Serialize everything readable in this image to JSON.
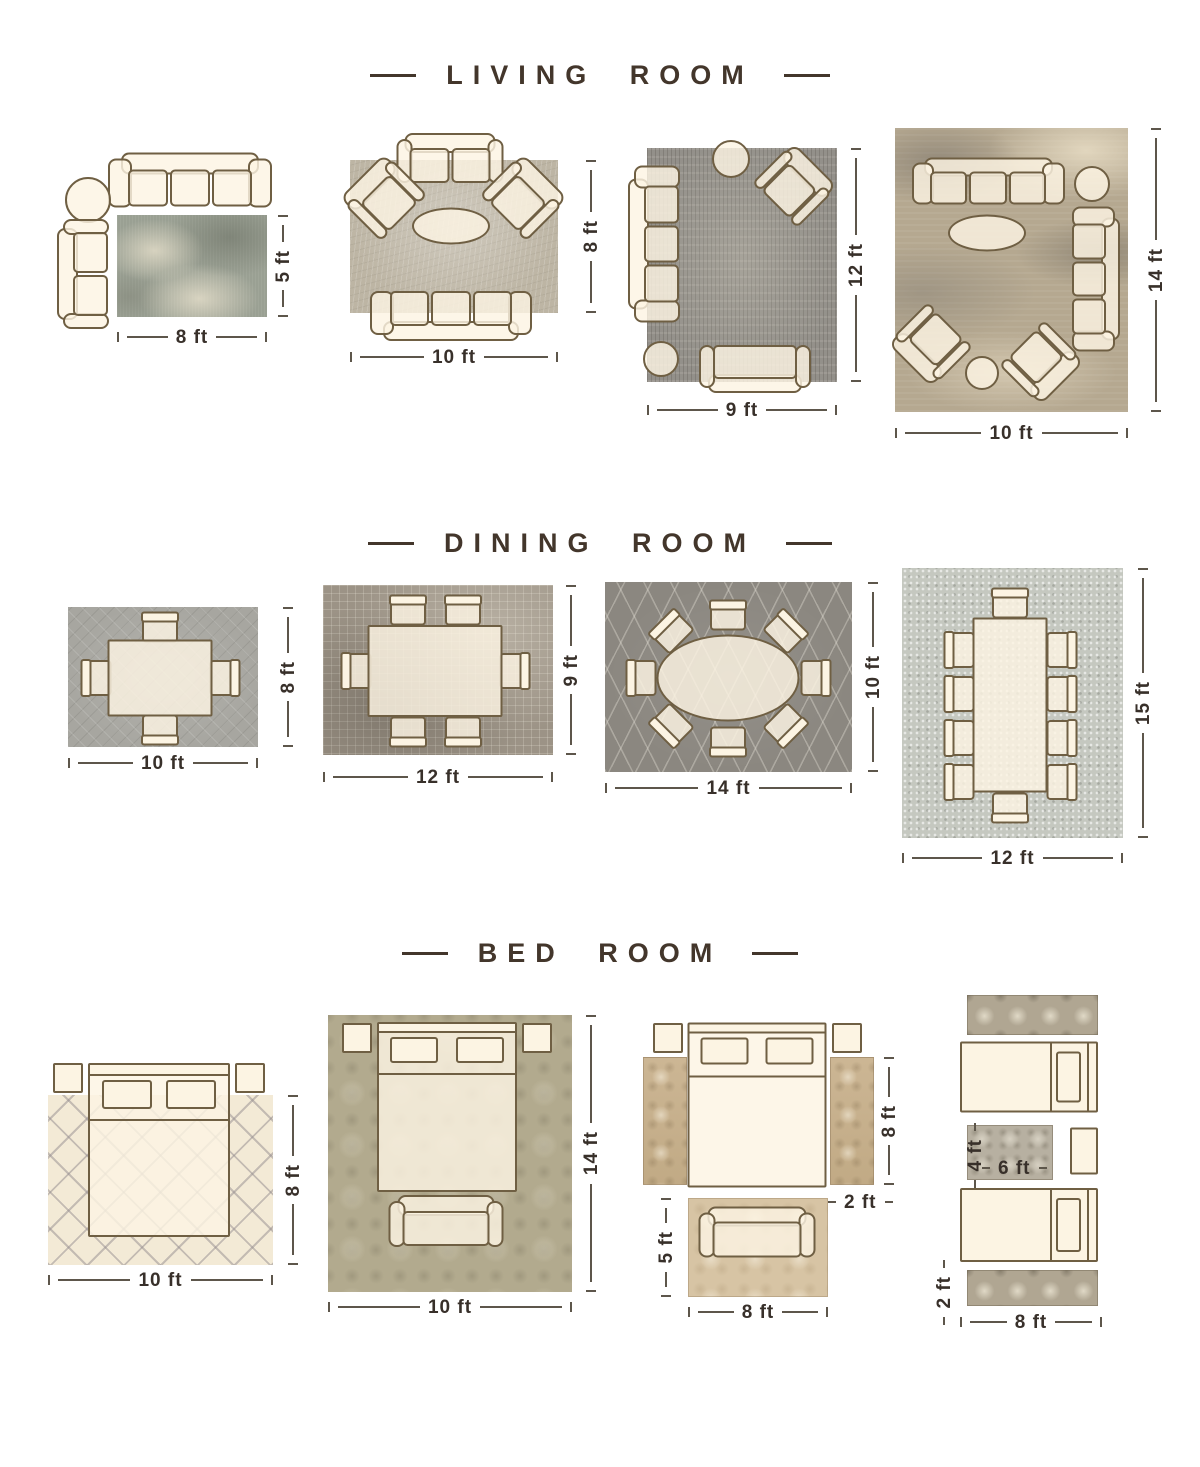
{
  "palette": {
    "title_text": "#43362b",
    "dimension_text": "#38302a",
    "furniture_outline": "#6f5f43",
    "furniture_fill": "#fcf4e3"
  },
  "sections": [
    {
      "title": "LIVING ROOM",
      "layouts": [
        {
          "width": "8 ft",
          "height": "5 ft"
        },
        {
          "width": "10 ft",
          "height": "8 ft"
        },
        {
          "width": "9 ft",
          "height": "12 ft"
        },
        {
          "width": "10 ft",
          "height": "14 ft"
        }
      ]
    },
    {
      "title": "DINING ROOM",
      "layouts": [
        {
          "width": "10 ft",
          "height": "8 ft"
        },
        {
          "width": "12 ft",
          "height": "9 ft"
        },
        {
          "width": "14 ft",
          "height": "10 ft"
        },
        {
          "width": "12 ft",
          "height": "15 ft"
        }
      ]
    },
    {
      "title": "BED ROOM",
      "layouts": [
        {
          "width": "10 ft",
          "height": "8 ft"
        },
        {
          "width": "10 ft",
          "height": "14 ft"
        },
        {
          "width": "8 ft",
          "side_height": "8 ft",
          "runner_width": "2 ft",
          "foot_rug_height": "5 ft"
        },
        {
          "width": "8 ft",
          "runner_width": "2 ft",
          "accent_width": "6 ft",
          "accent_height": "4 ft"
        }
      ]
    }
  ]
}
